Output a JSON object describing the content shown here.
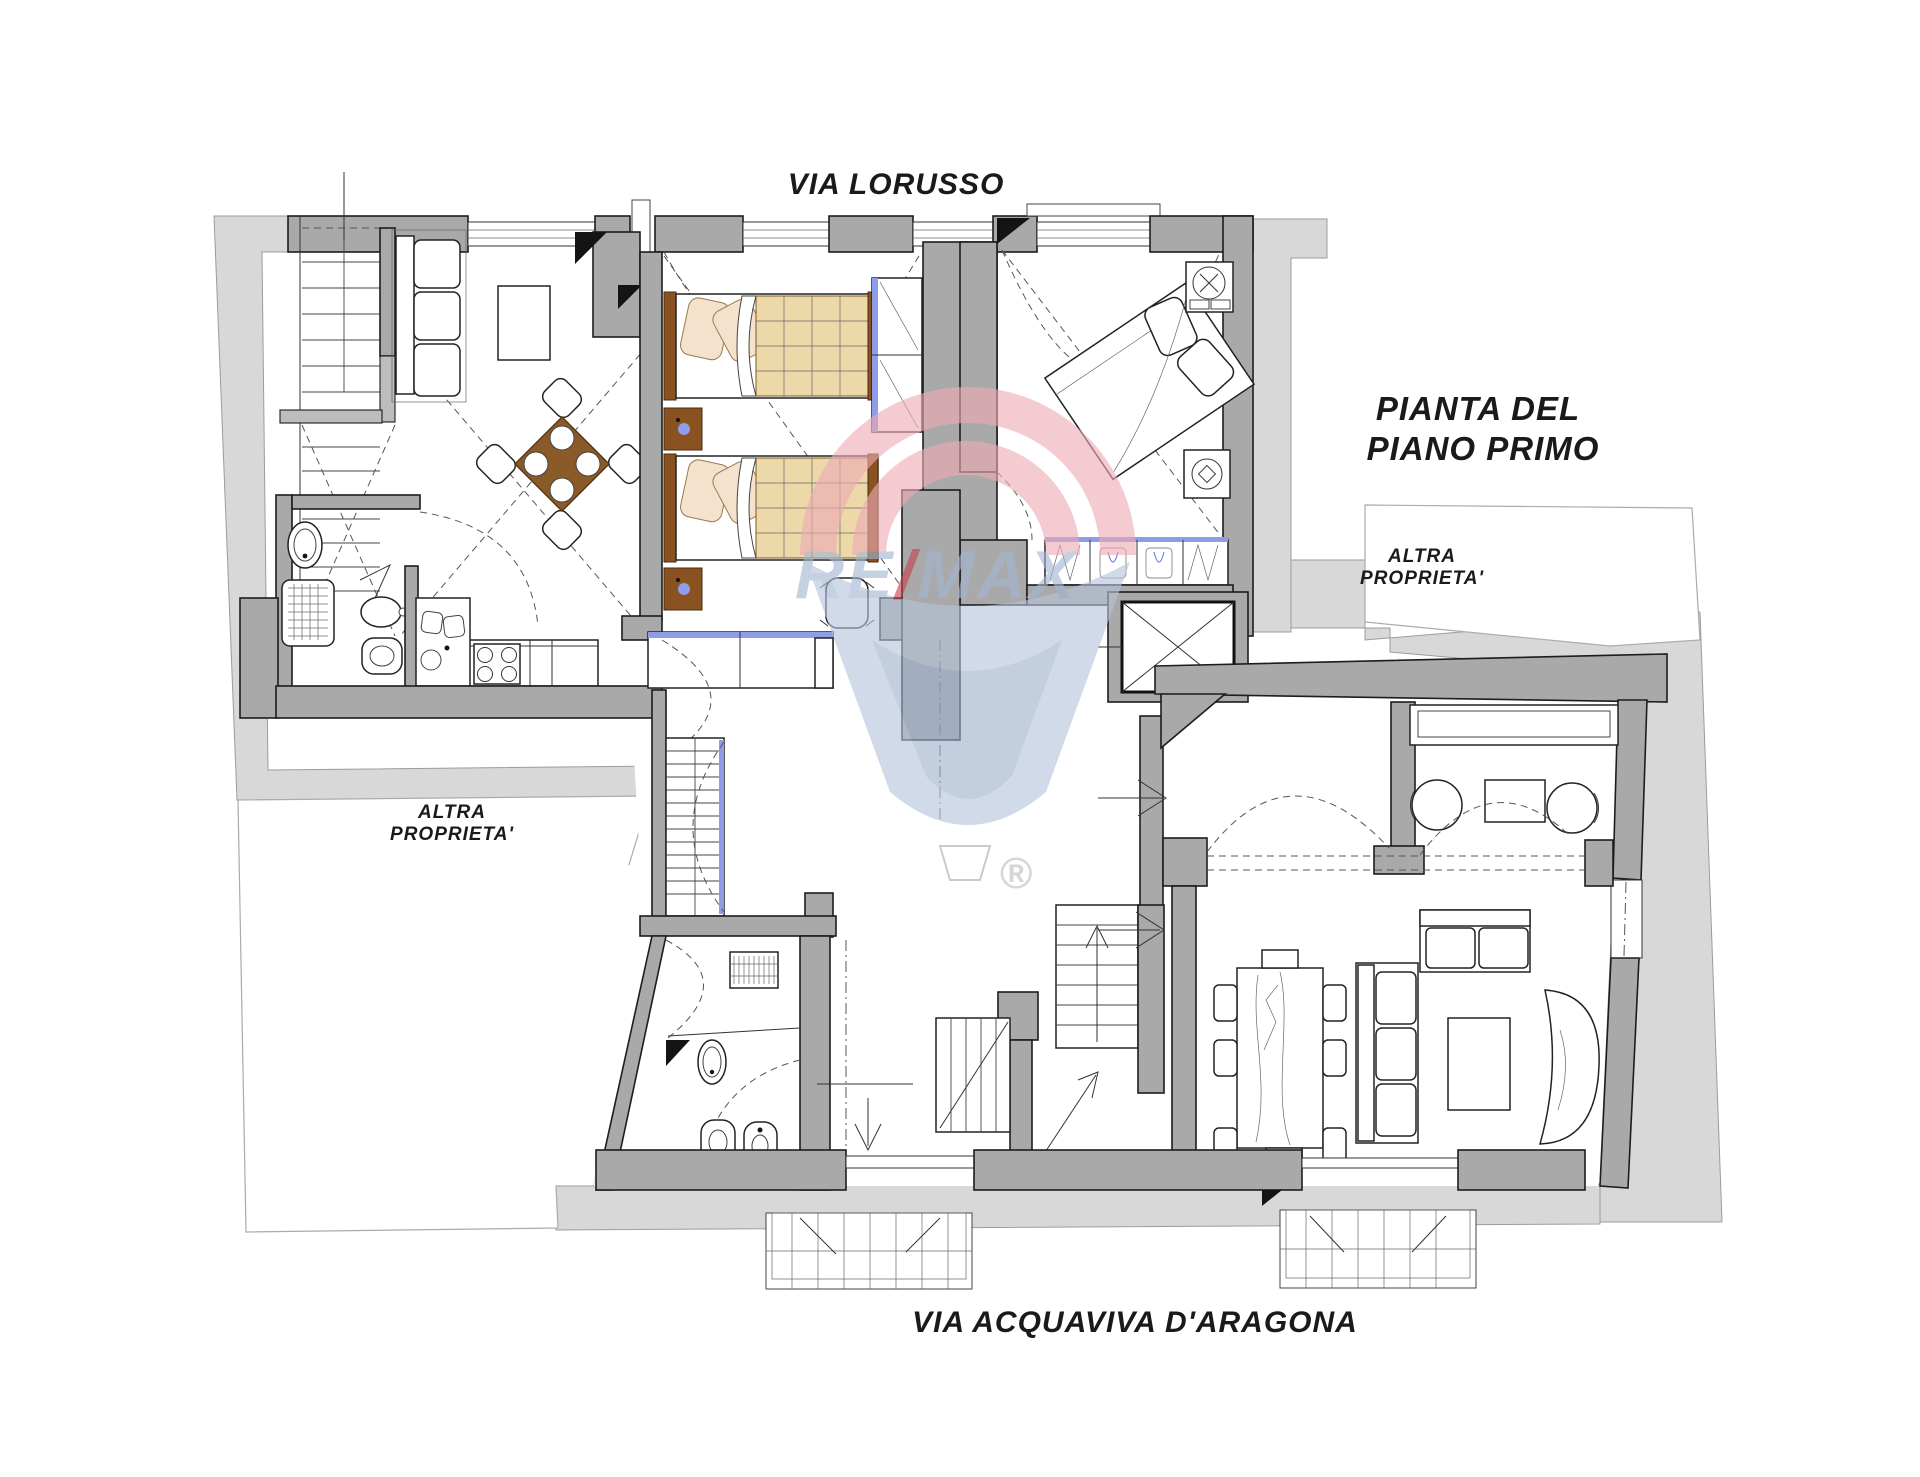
{
  "document": {
    "type": "floor-plan",
    "title": "Pianta del piano primo"
  },
  "labels": {
    "street_top": "VIA LORUSSO",
    "street_bottom": "VIA ACQUAVIVA D'ARAGONA",
    "plan_title_line1": "PIANTA DEL",
    "plan_title_line2": "PIANO PRIMO",
    "other_property_left_line1": "ALTRA",
    "other_property_left_line2": "PROPRIETA'",
    "other_property_right_line1": "ALTRA",
    "other_property_right_line2": "PROPRIETA'"
  },
  "watermark": {
    "brand_re": "RE",
    "brand_slash": "/",
    "brand_max": "MAX",
    "registered": "®"
  },
  "colors": {
    "street": "#d8d8d8",
    "wall": "#a9a9a9",
    "wall2": "#bdbdbd",
    "outline": "#1d1d1d",
    "label": "#1a1a1a",
    "accent-blue": "#8f9ce7",
    "wood": "#8a5a28",
    "wood-dark": "#5a3a15",
    "nightstand": "#8a5220",
    "bed-blanket": "#edd8aa",
    "pillow": "#f5e2cc",
    "balloon-red": "#ecacb4",
    "balloon-blue": "#b6c4da",
    "balloon-blue2": "#9fb2cd",
    "text-blue": "#a3b5d2",
    "slash-red": "#c4424e"
  }
}
